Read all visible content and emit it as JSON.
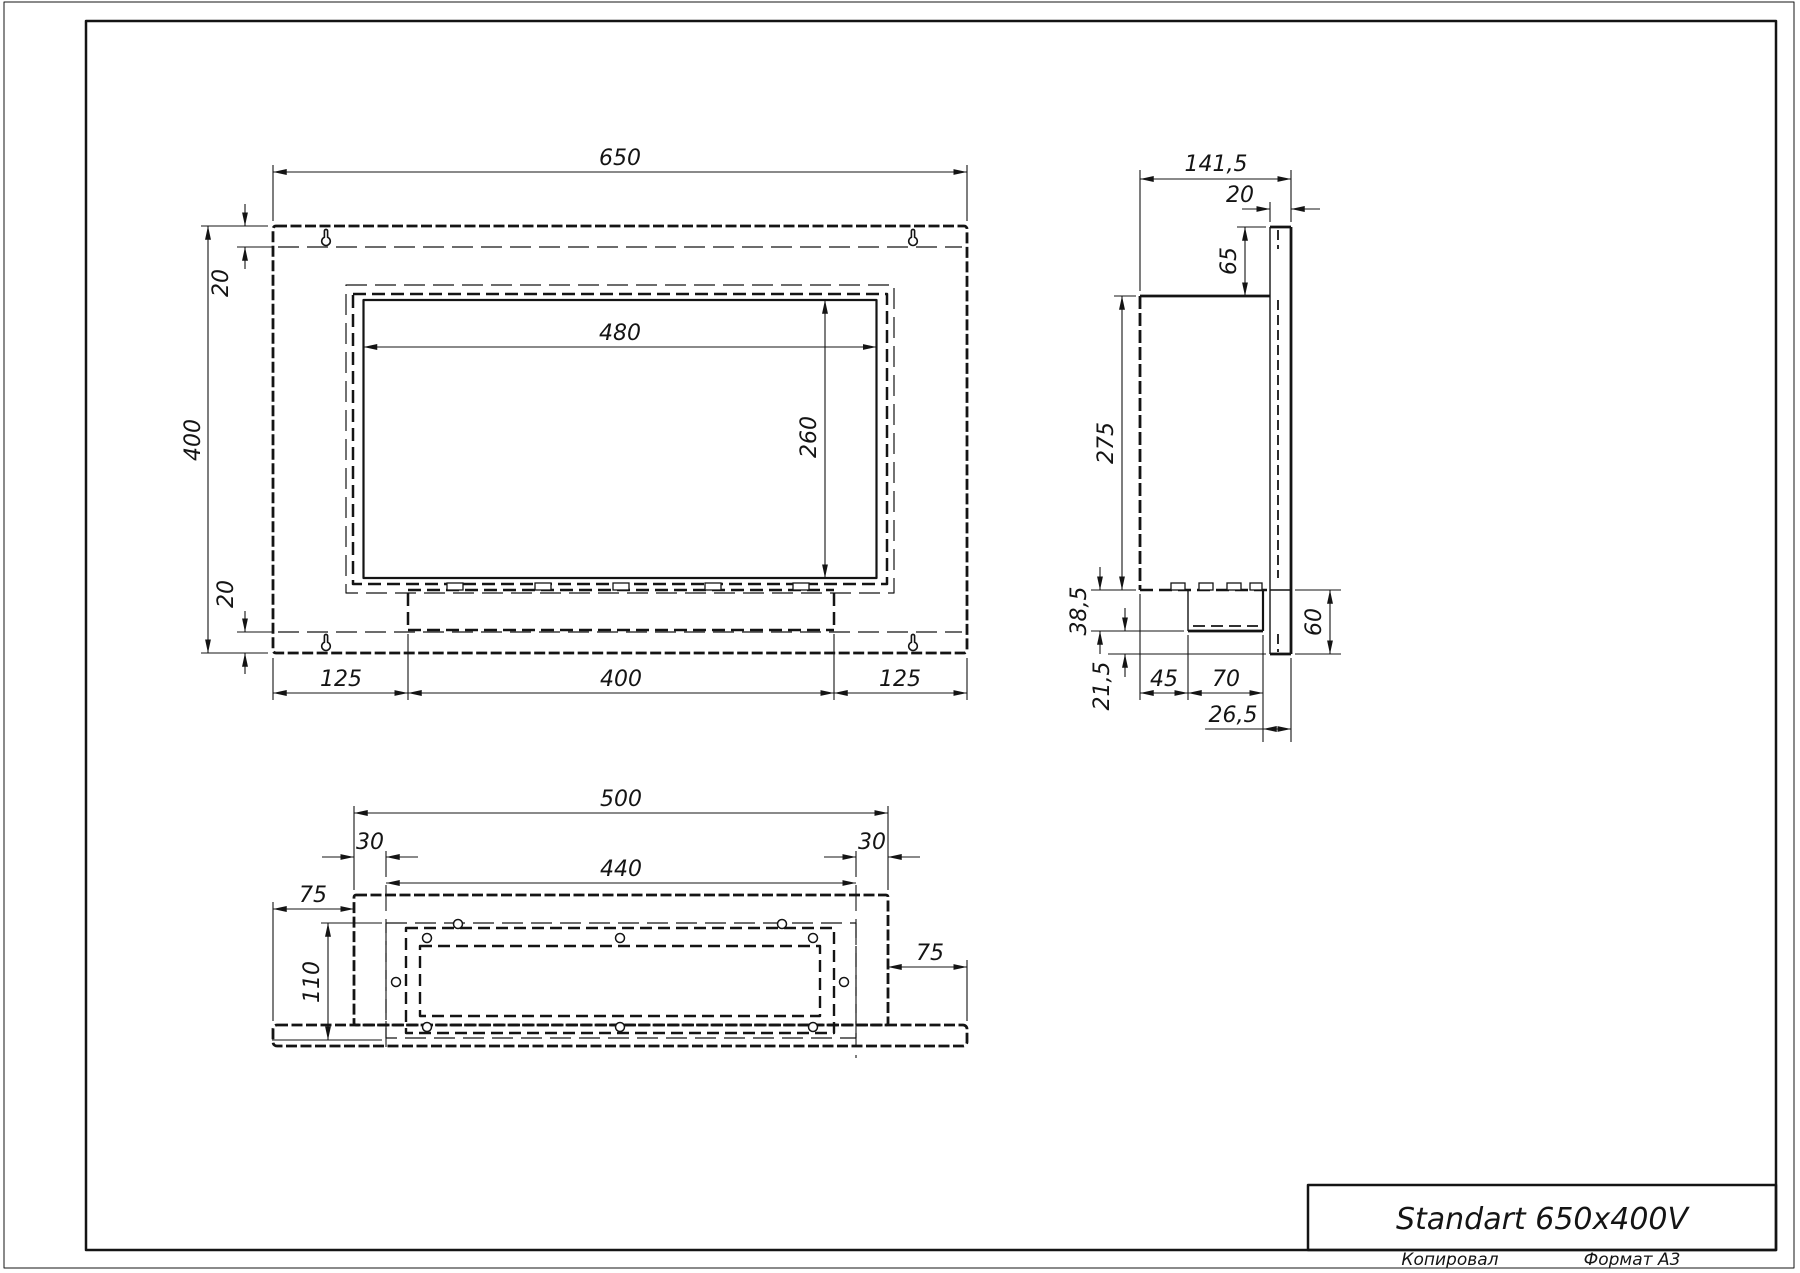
{
  "drawing": {
    "front": {
      "width": "650",
      "height": "400",
      "offset_top": "20",
      "offset_bottom": "20",
      "opening_width": "480",
      "opening_height": "260",
      "bottom_left": "125",
      "bottom_center": "400",
      "bottom_right": "125"
    },
    "side": {
      "depth": "141,5",
      "flange_thickness": "20",
      "top_inset": "65",
      "body_height": "275",
      "tray_drop": "38,5",
      "bottom_lip": "21,5",
      "tray_offset": "45",
      "tray_width": "70",
      "tray_to_front": "26,5",
      "lower_height": "60"
    },
    "bottom": {
      "body_width": "500",
      "inset_left": "30",
      "inset_right": "30",
      "inner_width": "440",
      "overhang_left": "75",
      "overhang_right": "75",
      "inner_depth": "110"
    }
  },
  "title_block": {
    "title": "Standart 650x400V"
  },
  "footer": {
    "copied": "Копировал",
    "format": "Формат А3"
  }
}
